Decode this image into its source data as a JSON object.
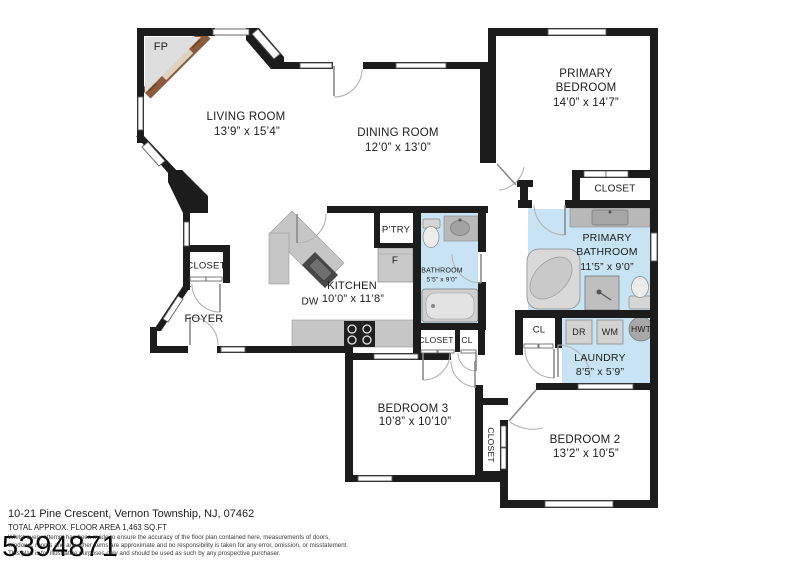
{
  "plan": {
    "rooms": {
      "living_room": {
        "name": "LIVING ROOM",
        "dims": "13’9” x 15’4”"
      },
      "dining_room": {
        "name": "DINING ROOM",
        "dims": "12’0” x 13’0”"
      },
      "primary_bedroom": {
        "name": "PRIMARY BEDROOM",
        "dims": "14’0” x 14’7”"
      },
      "primary_bathroom": {
        "name": "PRIMARY BATHROOM",
        "dims": "11’5” x 9’0”"
      },
      "bathroom": {
        "name": "BATHROOM",
        "dims": "5’5” x 9’0”"
      },
      "kitchen": {
        "name": "KITCHEN",
        "dims": "10’0” x 11’8”"
      },
      "laundry": {
        "name": "LAUNDRY",
        "dims": "8’5” x 5’9”"
      },
      "foyer": {
        "name": "FOYER"
      },
      "bedroom_2": {
        "name": "BEDROOM 2",
        "dims": "13’2” x 10’5”"
      },
      "bedroom_3": {
        "name": "BEDROOM 3",
        "dims": "10’8” x 10’10”"
      }
    },
    "closets": {
      "primary_closet": "CLOSET",
      "foyer_closet": "CLOSET",
      "hall_closet": "CLOSET",
      "hall_cl": "CL",
      "laundry_cl": "CL",
      "bedroom_closet": "CLOSET"
    },
    "appliances": {
      "fireplace": "FP",
      "dishwasher": "DW",
      "fridge": "F",
      "pantry": "P’TRY",
      "dryer": "DR",
      "washer": "WM",
      "water_heater": "HWT"
    }
  },
  "footer": {
    "address": "10-21 Pine Crescent, Vernon Township, NJ, 07462",
    "floor_area": "TOTAL APPROX. FLOOR AREA 1,463 SQ.FT",
    "disclaimer_lines": [
      "Whilst every attempt has been made to ensure the accuracy of the floor plan contained here, measurements of doors,",
      "windows, rooms and any other items are approximate and no responsibility is taken for any error, omission, or misstatement.",
      "This plan is for illustrative purposes only and should be used as such by any prospective purchaser."
    ],
    "watermark": "5394871"
  },
  "colors": {
    "wall": "#1c1c1c",
    "wet_area": "#c7e3f4",
    "counter": "#c6c6c6",
    "brick": "#8b5a3b"
  }
}
